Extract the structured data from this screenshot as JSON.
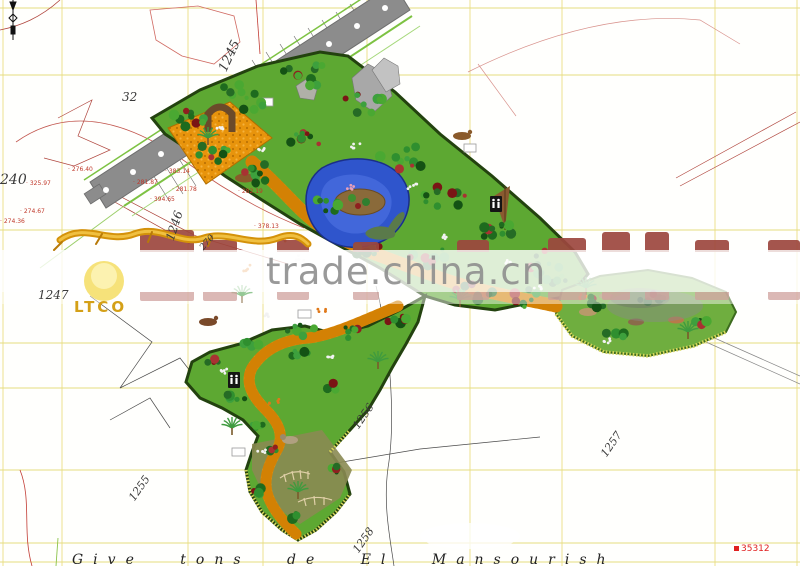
{
  "watermark": {
    "site_text": "trade.china.cn"
  },
  "logo": {
    "text": "LTCO"
  },
  "caption": {
    "text": "Give tons de El Mansourish"
  },
  "benchmark": {
    "value": "35312"
  },
  "parcels": {
    "p32": "32",
    "p240": "240",
    "p270": "270",
    "p1245": "1245",
    "p1246": "1246",
    "p1247": "1247",
    "p1255": "1255",
    "p1256": "1256",
    "p1257": "1257",
    "p1258": "1258"
  },
  "spot_elevations": [
    "325.97",
    "274.67",
    "274.36",
    "276.40",
    "383.14",
    "281.78",
    "282.19",
    "281.87",
    "394.65",
    "378.13"
  ],
  "colors": {
    "park_green": "#5da832",
    "path_orange": "#e8940c",
    "pond_blue": "#2f55cc",
    "road_gray": "#8c8c8c",
    "grid_yellow": "#e8e08a",
    "brand_red": "#9c463e",
    "watermark_gray": "#909090",
    "marker_red": "#e02020"
  }
}
